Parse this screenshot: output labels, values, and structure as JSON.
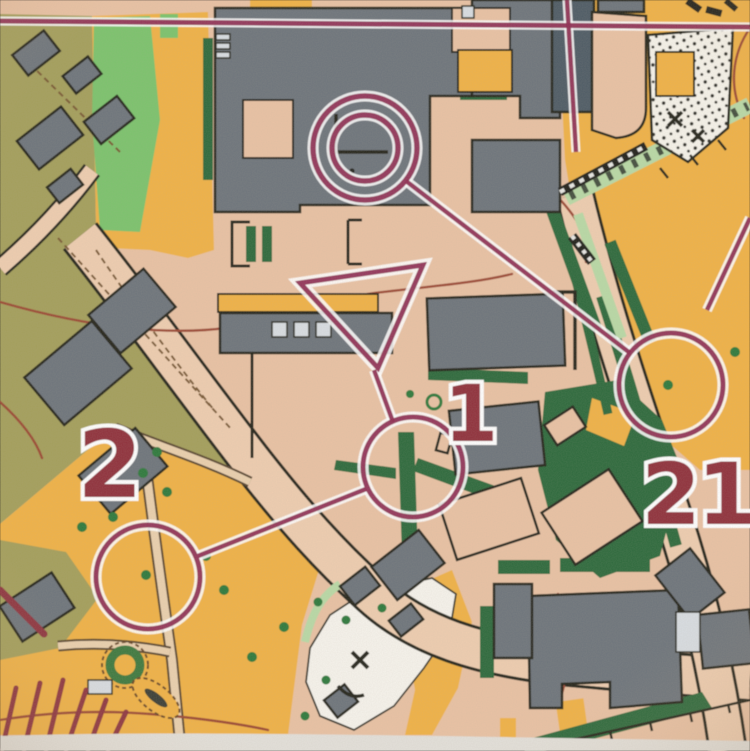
{
  "map": {
    "kind": "photo of a printed sprint orienteering course map",
    "course": {
      "start_symbol": "triangle",
      "finish_symbol": "double-circle",
      "controls": [
        {
          "label": "1"
        },
        {
          "label": "2"
        },
        {
          "label": "21"
        }
      ]
    },
    "colors": {
      "paved": "#e9c2a4",
      "road_fill": "#eecdb0",
      "open_yellow": "#f0b247",
      "olive_restricted": "#a49f5c",
      "rough_open_green": "#7cc36d",
      "vegetation_light": "#b9d9a6",
      "vegetation_dark": "#2f6b3d",
      "tree_green": "#2e7a3c",
      "forest_white": "#f6f3ec",
      "building_gray": "#6e747c",
      "building_dark": "#4f5b66",
      "canopy_gray": "#d8dde2",
      "line_black": "#26261f",
      "contour_brown": "#9c4836",
      "course_purple": "#8e2d52",
      "number_red": "#90303c",
      "stripes_maroon": "#8e3440",
      "paper_edge": "#e3e0da"
    },
    "symbols": [
      "start-triangle",
      "finish-double-circle",
      "control-circle",
      "control-number",
      "course-leg-line",
      "tree-dot",
      "hedge",
      "building",
      "canopy",
      "road",
      "paved-area",
      "forbidden-stripes",
      "contour-line",
      "fence-with-ticks",
      "stairs",
      "dotted-ground",
      "cliff",
      "x-feature",
      "pond",
      "circular-planting"
    ]
  }
}
